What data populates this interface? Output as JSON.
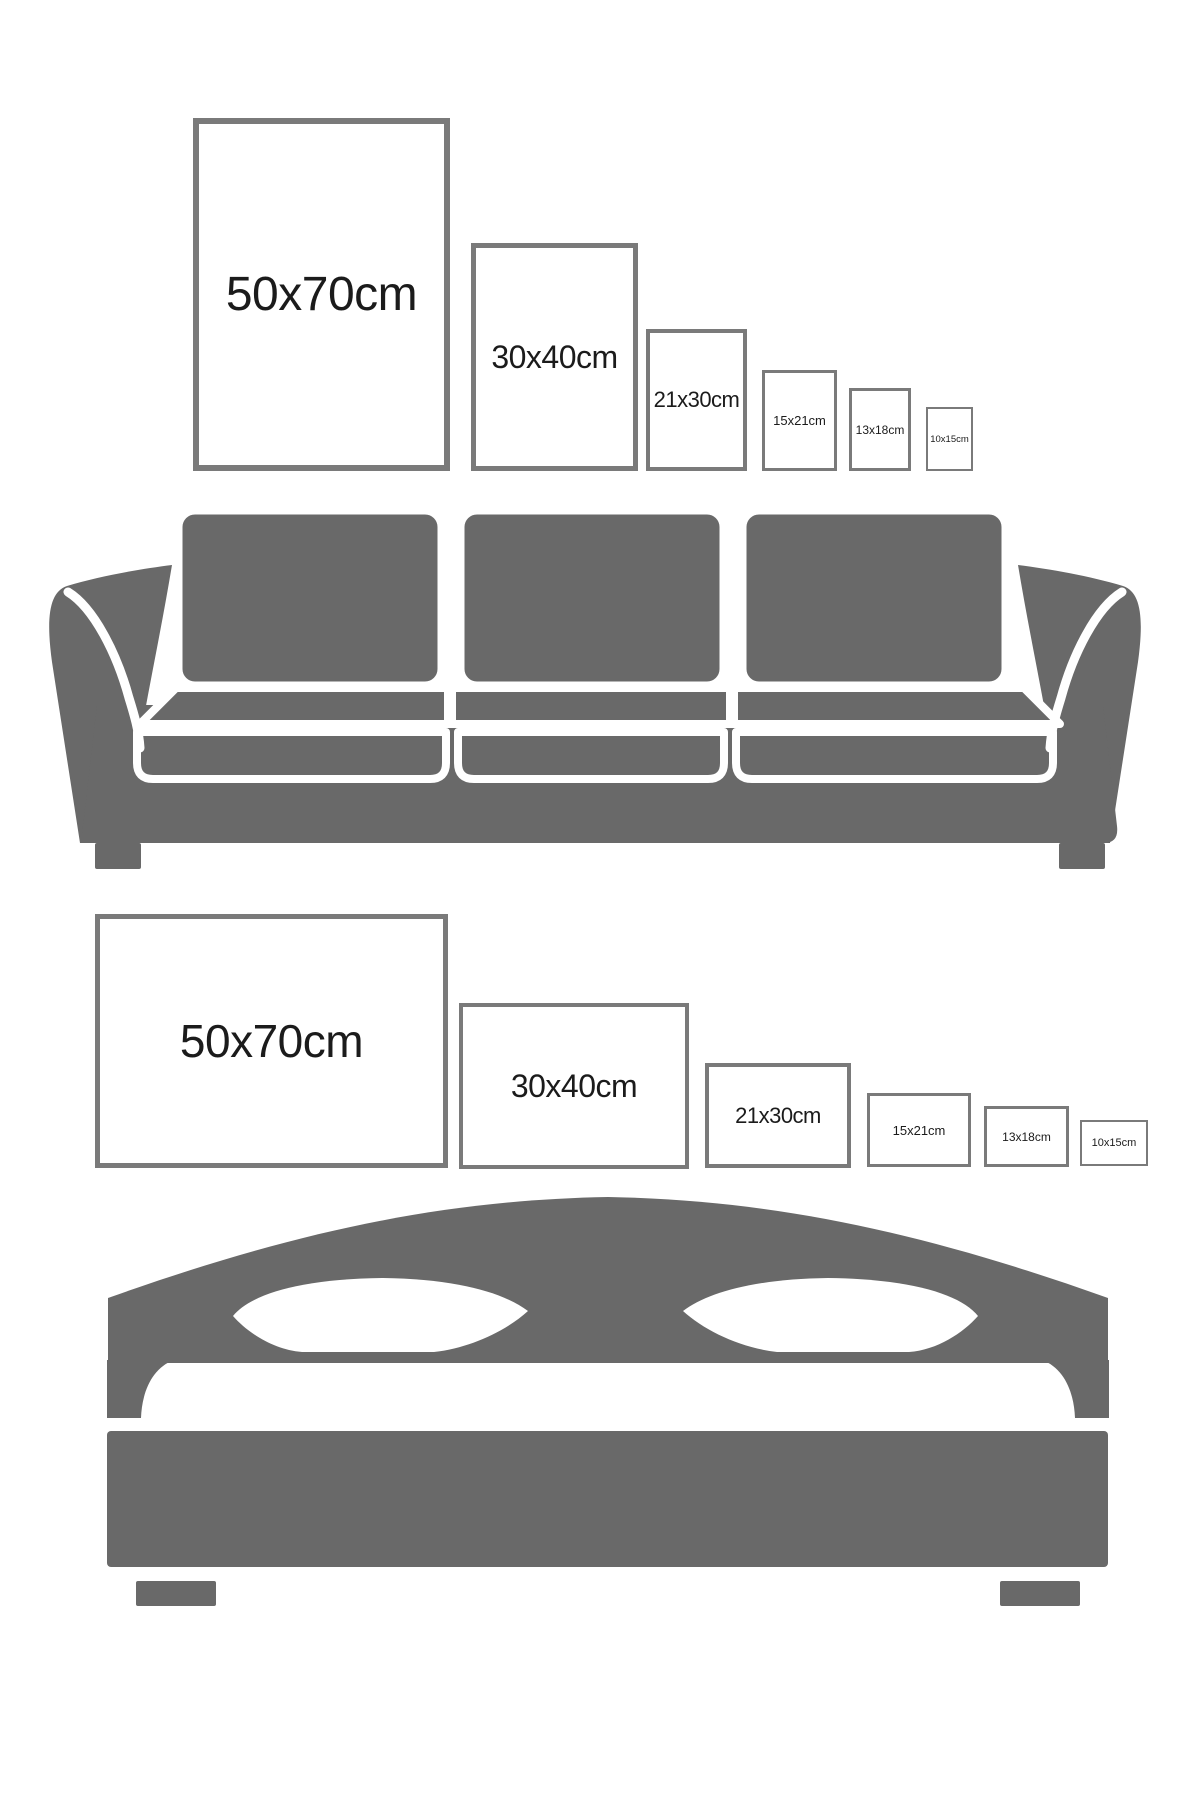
{
  "colors": {
    "background": "#ffffff",
    "furniture_gray": "#696969",
    "frame_border_gray": "#7a7a7a",
    "frame_fill": "#ffffff",
    "label_text": "#1b1b1b"
  },
  "sofa_section": {
    "illustration": "three-seat-sofa-silhouette",
    "frames": [
      {
        "label": "50x70cm"
      },
      {
        "label": "30x40cm"
      },
      {
        "label": "21x30cm"
      },
      {
        "label": "15x21cm"
      },
      {
        "label": "13x18cm"
      },
      {
        "label": "10x15cm"
      }
    ]
  },
  "bed_section": {
    "illustration": "double-bed-silhouette",
    "frames": [
      {
        "label": "50x70cm"
      },
      {
        "label": "30x40cm"
      },
      {
        "label": "21x30cm"
      },
      {
        "label": "15x21cm"
      },
      {
        "label": "13x18cm"
      },
      {
        "label": "10x15cm"
      }
    ]
  }
}
